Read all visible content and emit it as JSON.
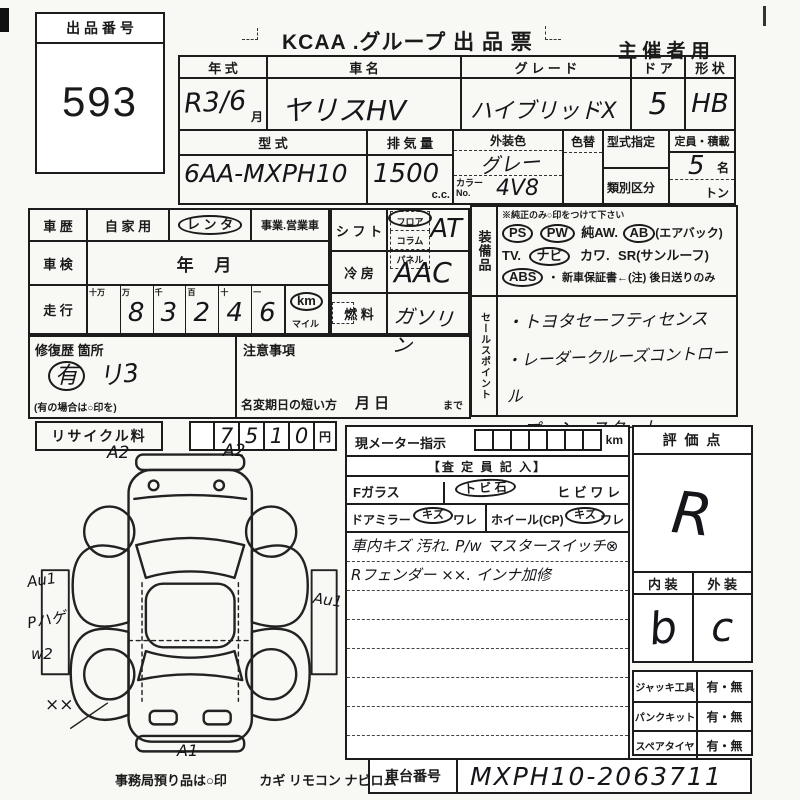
{
  "header": {
    "auction_no_label": "出 品 番 号",
    "auction_no": "593",
    "title": "KCAA .グループ 出 品 票",
    "organizer": "主 催 者 用"
  },
  "top_table": {
    "year_label": "年  式",
    "year_value": "R3/6",
    "year_unit": "月",
    "name_label": "車    名",
    "name_value": "ヤリスHV",
    "grade_label": "グ レ ー ド",
    "grade_value": "ハイブリッドX",
    "door_label": "ド ア",
    "door_value": "5",
    "shape_label": "形 状",
    "shape_value": "HB",
    "model_label": "型    式",
    "model_value": "6AA-MXPH10",
    "disp_label": "排 気 量",
    "disp_value": "1500",
    "disp_unit": "c.c.",
    "color_label": "外装色",
    "color_value": "グレー",
    "color_no_label": "カラーNo.",
    "color_no_value": "4V8",
    "color_change_label": "色替",
    "type_desig_label": "型式指定",
    "class_label": "類別区分",
    "capacity_label": "定員・積載",
    "capacity_value": "5",
    "capacity_unit": "名",
    "load_unit": "トン"
  },
  "history": {
    "label": "車 歴",
    "private": "自 家 用",
    "rental": "レ ン タ",
    "business": "事業.営業車",
    "inspection_label": "車 検",
    "inspection_value": "年        月",
    "mileage_label": "走 行",
    "digit_headers": [
      "十万",
      "万",
      "千",
      "百",
      "十",
      "一"
    ],
    "digits": [
      "",
      "8",
      "3",
      "2",
      "4",
      "6"
    ],
    "unit_km": "km",
    "unit_mile": "マイル"
  },
  "repair": {
    "label": "修復歴 箇所",
    "mark": "有",
    "note": "リ3",
    "hint": "(有の場合は○印を)",
    "caution_label": "注意事項",
    "name_change_label": "名変期日の短い方",
    "name_change_value": "月      日",
    "name_change_suffix": "まで"
  },
  "recycle": {
    "label": "リサイクル料",
    "digits": [
      "7",
      "5",
      "1",
      "0"
    ],
    "unit": "円"
  },
  "shift": {
    "label": "シ フ ト",
    "options": [
      "フロア",
      "コラム",
      "パネル"
    ],
    "value": "AT"
  },
  "ac": {
    "label": "冷 房",
    "value": "AAC"
  },
  "fuel": {
    "label": "燃 料",
    "value": "ガソリン"
  },
  "equipment": {
    "label": "装備品",
    "note": "※純正のみ○印をつけて下さい",
    "ps": "PS",
    "pw": "PW",
    "aw": "純AW.",
    "ab": "AB",
    "ab_suffix": "(エアバック)",
    "tv": "TV.",
    "navi": "ナビ",
    "kawa": "カワ.",
    "sr": "SR(サンルーフ)",
    "abs": "ABS",
    "warranty": "・ 新車保証書←(注) 後日送りのみ"
  },
  "sales_points": {
    "label": "セールスポイント",
    "items": [
      "・トヨタセーフティセンス",
      "・レーダークルーズコントロール",
      "・プッシュスタート"
    ]
  },
  "meter": {
    "label": "現メーター指示",
    "unit": "km"
  },
  "assessor": {
    "header": "【査 定 員 記 入】",
    "f_glass": "Fガラス",
    "tobi_ishi": "ト ビ 石",
    "hibiware": "ヒ ビ ワ レ",
    "door_mirror": "ドアミラー",
    "kizu": "キズ",
    "ware": "ワレ",
    "wheel": "ホイール(CP)",
    "dot": "・",
    "notes": [
      "車内キズ 汚れ. P/w マスタースイッチ⊗",
      "Rフェンダー ××. インナ加修"
    ]
  },
  "evaluation": {
    "label": "評 価 点",
    "score": "R",
    "interior_label": "内 装",
    "exterior_label": "外 装",
    "interior": "b",
    "exterior": "c"
  },
  "accessories": {
    "jack_label": "ジャッキ工具",
    "jack_value": "有・無",
    "puncture_label": "パンクキット",
    "puncture_value": "有・無",
    "spare_label": "スペアタイヤ",
    "spare_value": "有・無"
  },
  "chassis": {
    "label": "車台番号",
    "value": "MXPH10-2063711"
  },
  "footer": {
    "note": "事務局預り品は○印",
    "items": "カギ  リモコン  ナビロム"
  },
  "diagram": {
    "a2_left": "A2",
    "a2_right": "A2",
    "au1_left": "Au1",
    "p_hage": "Pハゲ",
    "w2": "w2",
    "xx": "××",
    "a1": "A1",
    "au1_right": "Au1"
  }
}
